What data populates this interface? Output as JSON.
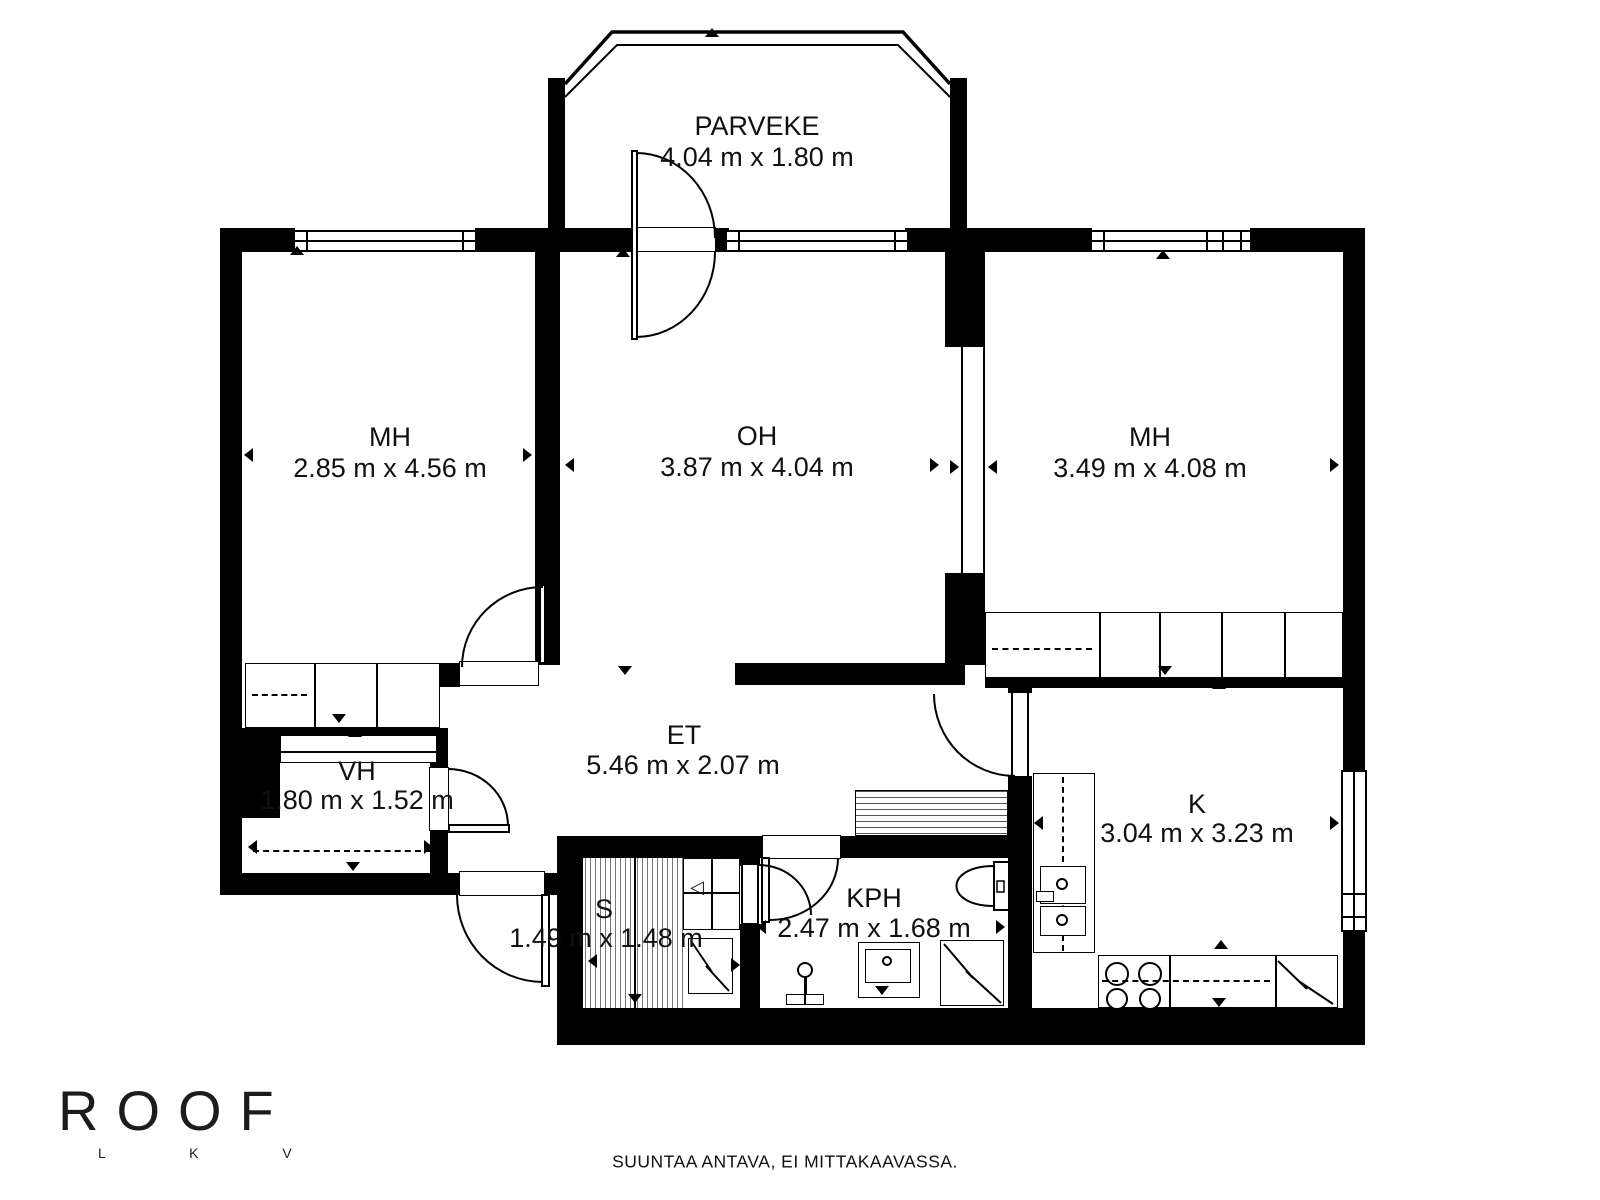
{
  "floorplan": {
    "rooms": [
      {
        "id": "parveke",
        "label": "PARVEKE",
        "dims": "4.04 m x 1.80 m"
      },
      {
        "id": "mh-left",
        "label": "MH",
        "dims": "2.85 m x 4.56 m"
      },
      {
        "id": "oh",
        "label": "OH",
        "dims": "3.87 m x 4.04 m"
      },
      {
        "id": "mh-right",
        "label": "MH",
        "dims": "3.49 m x 4.08 m"
      },
      {
        "id": "vh",
        "label": "VH",
        "dims": "1.80 m x 1.52 m"
      },
      {
        "id": "et",
        "label": "ET",
        "dims": "5.46 m x 2.07 m"
      },
      {
        "id": "sauna",
        "label": "S",
        "dims": "1.49 m x 1.48 m"
      },
      {
        "id": "kph",
        "label": "KPH",
        "dims": "2.47 m x 1.68 m"
      },
      {
        "id": "kitchen",
        "label": "K",
        "dims": "3.04 m x 3.23 m"
      }
    ],
    "logo": {
      "brand": "ROOF",
      "sub": "L K V"
    },
    "footer": {
      "disclaimer": "SUUNTAA ANTAVA, EI MITTAKAAVASSA."
    },
    "colors": {
      "wall": "#000000",
      "background": "#ffffff"
    }
  }
}
